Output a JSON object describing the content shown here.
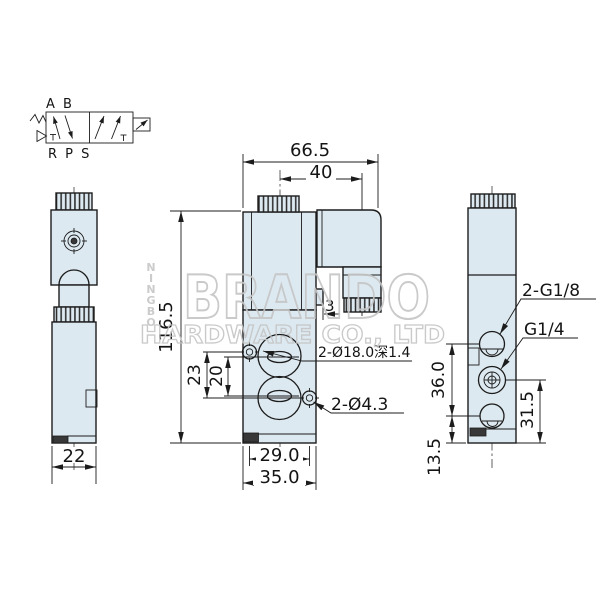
{
  "symbol": {
    "top_ports": "A B",
    "bottom_ports": "R P S"
  },
  "left_view": {
    "width": "22"
  },
  "front_view": {
    "overall_width": "66.5",
    "connector_offset": "40",
    "overall_height": "116.5",
    "mount_hole_pitch_v": "23",
    "port_pitch_v": "20",
    "tab_depth": "3",
    "counterbore_label": "2-Ø18.0深1.4",
    "mount_hole_label": "2-Ø4.3",
    "mount_hole_pitch_h": "29.0",
    "body_width": "35.0"
  },
  "right_view": {
    "side_ports_label": "2-G1/8",
    "output_port_label": "G1/4",
    "port_span": "36.0",
    "output_port_height": "31.5",
    "bottom_port_height": "13.5"
  },
  "watermark": {
    "brand": "BRANDO",
    "company": "HARDWARE CO., LTD",
    "vertical_letters": [
      "N",
      "I",
      "N",
      "G",
      "B",
      "O"
    ]
  },
  "colors": {
    "body_fill": "#dde9f0",
    "line": "#1c1c1c",
    "watermark": "#c5c5c5",
    "background": "#ffffff"
  }
}
